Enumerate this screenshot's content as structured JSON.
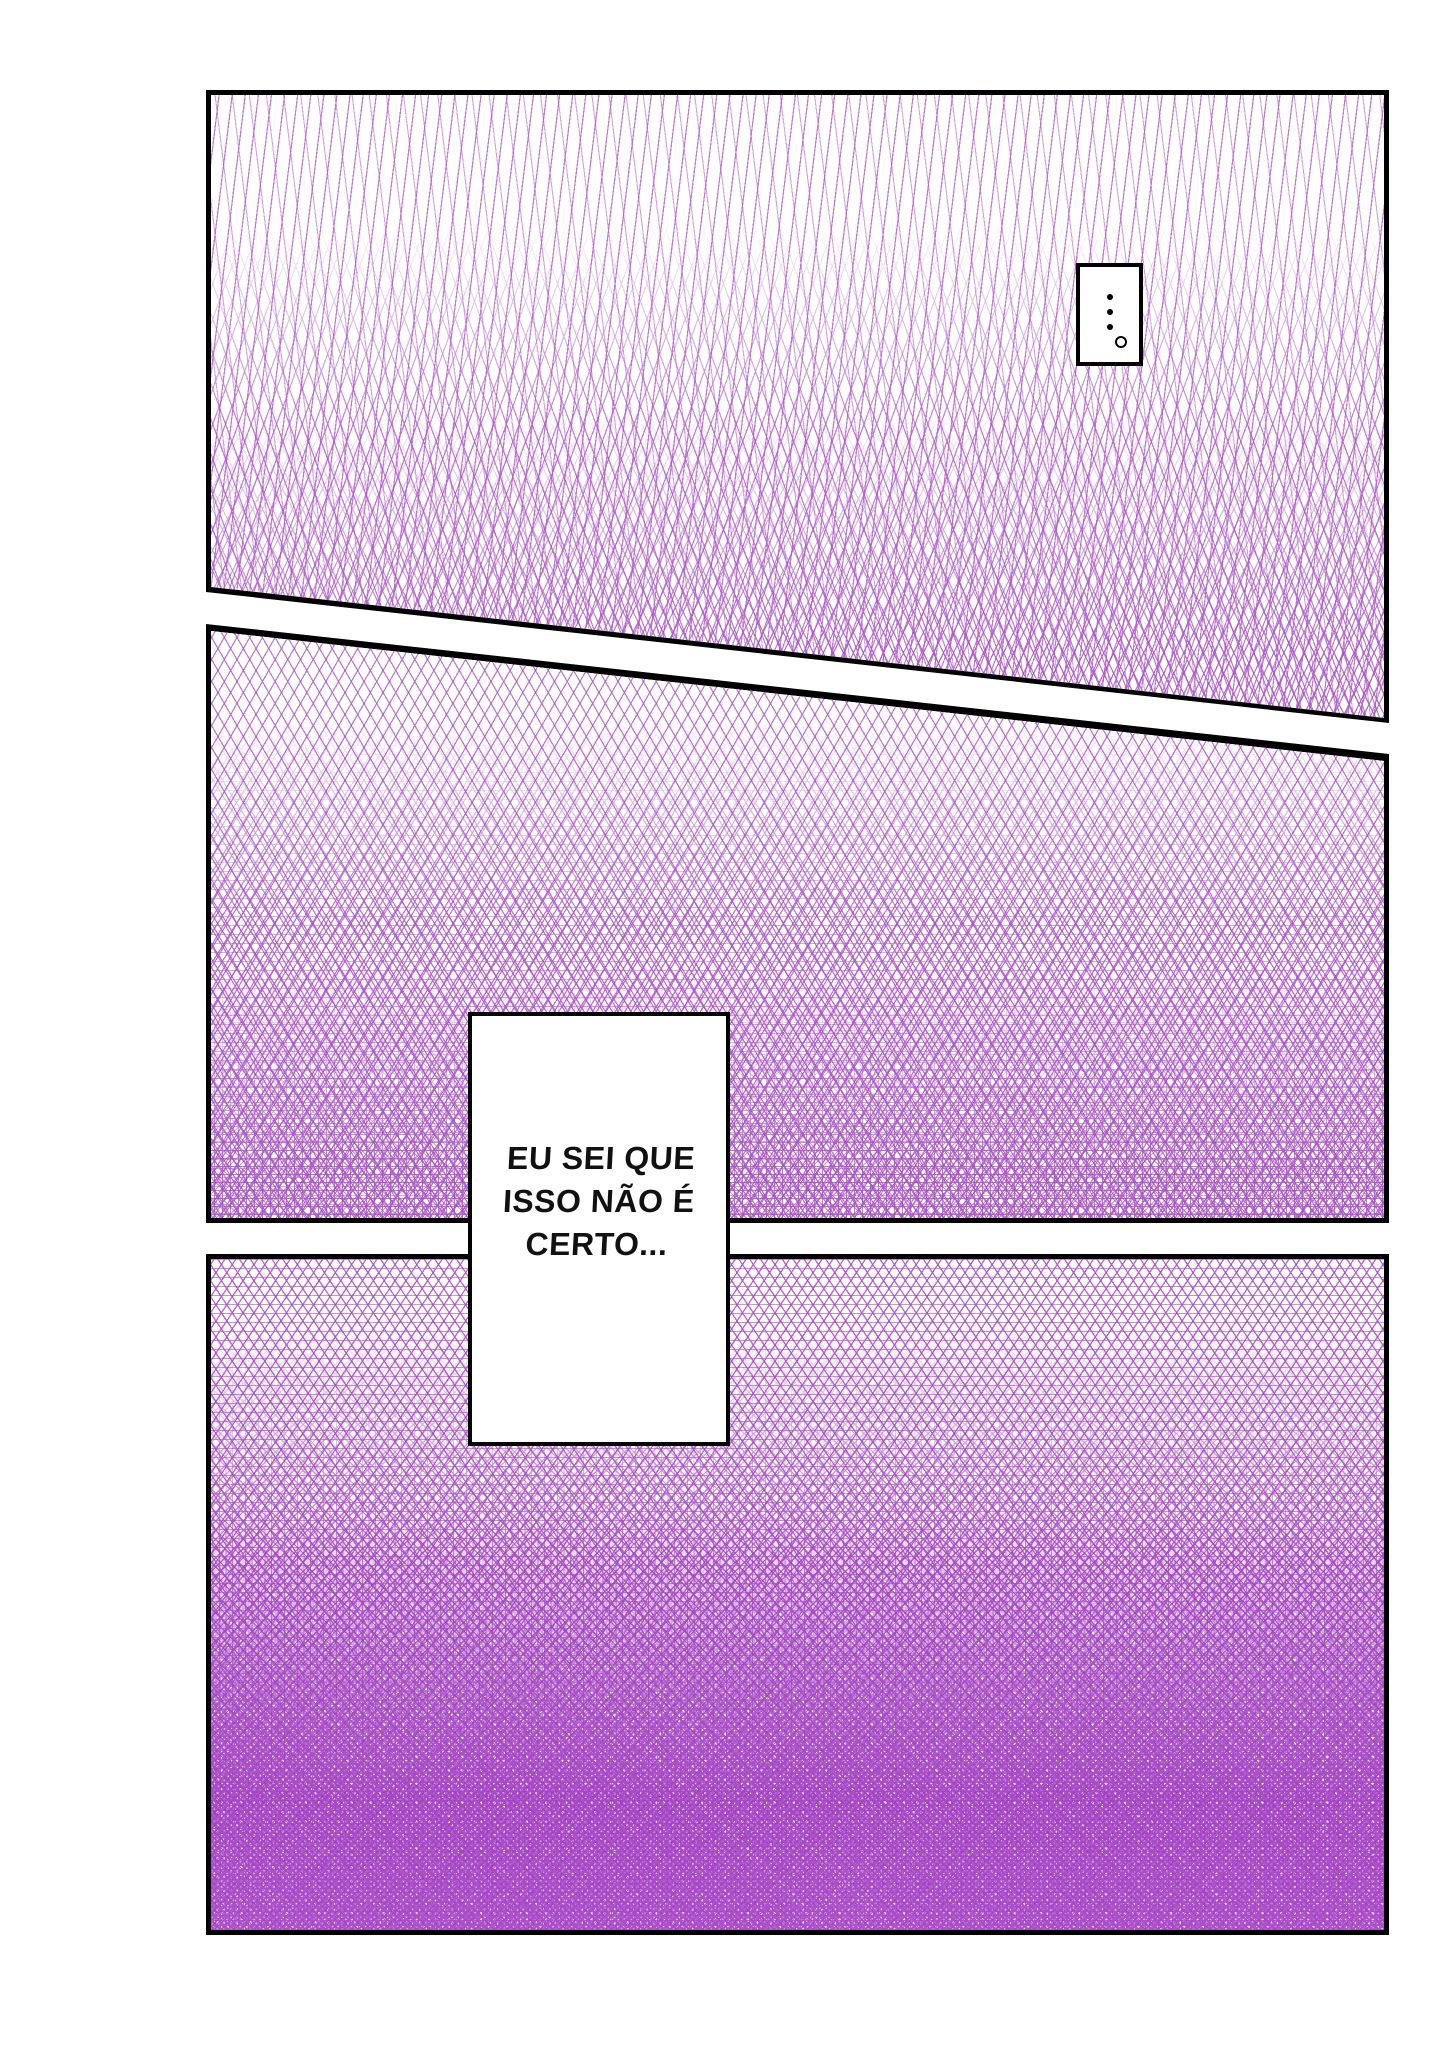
{
  "page": {
    "background": "#ffffff",
    "panel_count": 3
  },
  "colors": {
    "panel_border": "#000000",
    "tone_purple_light": "#c184d6",
    "tone_purple": "#aa50c8",
    "tone_purple_deep": "#9431b8",
    "bubble_background": "#ffffff",
    "bubble_border": "#000000",
    "text": "#111111"
  },
  "panels": [
    {
      "id": "panel-1",
      "art": "purple screentone, sparse zigzag lines fading into crosshatch, slanted bottom edge"
    },
    {
      "id": "panel-2",
      "art": "purple crosshatch screentone growing denser toward bottom, slanted top edge"
    },
    {
      "id": "panel-3",
      "art": "dense purple lattice screentone, nearly solid at bottom"
    }
  ],
  "thought_bubble": {
    "text": "⋮。"
  },
  "speech_bubble": {
    "lines": [
      "EU SEI QUE",
      "ISSO NÃO É",
      "CERTO..."
    ],
    "full_text": "EU SEI QUE ISSO NÃO É CERTO..."
  }
}
